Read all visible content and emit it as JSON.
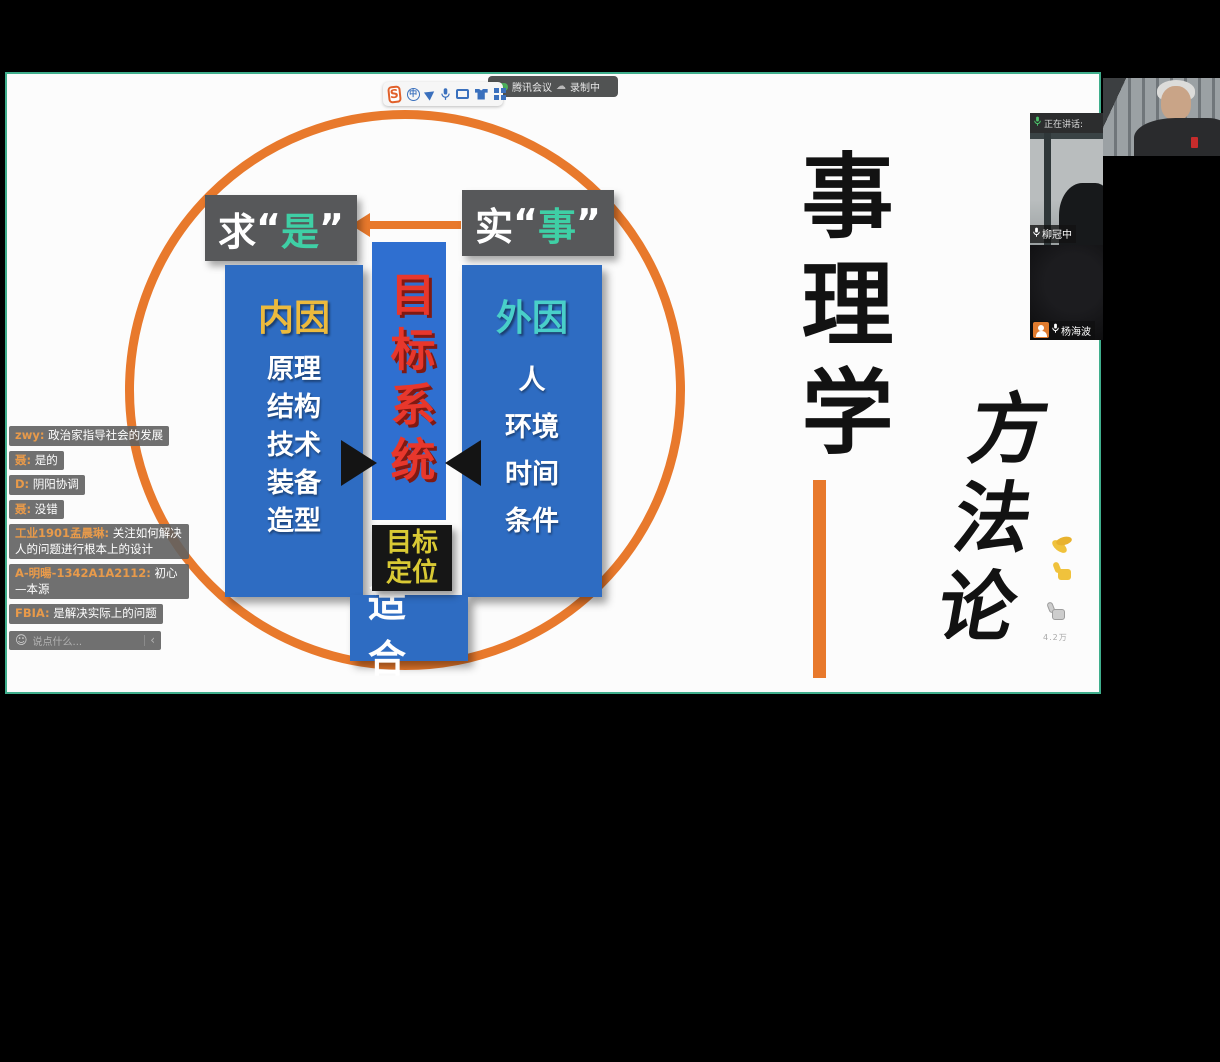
{
  "meeting": {
    "share_toolbar": {
      "logo_char": "S",
      "lang_char": "中"
    },
    "recording_pill": {
      "app_name": "腾讯会议",
      "status": "录制中"
    },
    "speaking_bar": "正在讲话:",
    "participants": [
      {
        "name": "柳冠中"
      },
      {
        "name": "杨海波"
      }
    ],
    "reactions": {
      "like_label": "4.2万"
    }
  },
  "chat": {
    "messages": [
      {
        "user": "zwy:",
        "text": "政治家指导社会的发展"
      },
      {
        "user": "聂:",
        "text": "是的"
      },
      {
        "user": "D:",
        "text": "阴阳协调"
      },
      {
        "user": "聂:",
        "text": "没错"
      },
      {
        "user": "工业1901孟晨琳:",
        "text": "关注如何解决人的问题进行根本上的设计"
      },
      {
        "user": "A-明暘-1342A1A2112:",
        "text": "初心—本源"
      },
      {
        "user": "FBIA:",
        "text": "是解决实际上的问题"
      }
    ],
    "input_placeholder": "说点什么..."
  },
  "slide": {
    "seek_truth": {
      "prefix": "求",
      "open": "“",
      "char": "是",
      "close": "”"
    },
    "from_facts": {
      "prefix": "实",
      "open": "“",
      "char": "事",
      "close": "”"
    },
    "inner": {
      "title": "内因",
      "items": [
        "原理",
        "结构",
        "技术",
        "装备",
        "造型"
      ]
    },
    "center_title": "目标系统",
    "outer": {
      "title": "外因",
      "items": [
        "人",
        "环境",
        "时间",
        "条件"
      ]
    },
    "goal_position": "目标定位",
    "fit": "适 合",
    "right_title": "事理学",
    "right_subtitle": "方法论"
  },
  "colors": {
    "accent_orange": "#e8792c",
    "box_blue": "#2e6cc2",
    "label_gray": "#57585a",
    "teal_text": "#3fcfa5",
    "gold_text": "#ecba3d",
    "red_text": "#e8372c",
    "goal_yellow": "#d9c934",
    "share_border_green": "#3fae8c",
    "chat_name_orange": "#e89a4a",
    "avatar_orange": "#e07b2e"
  }
}
